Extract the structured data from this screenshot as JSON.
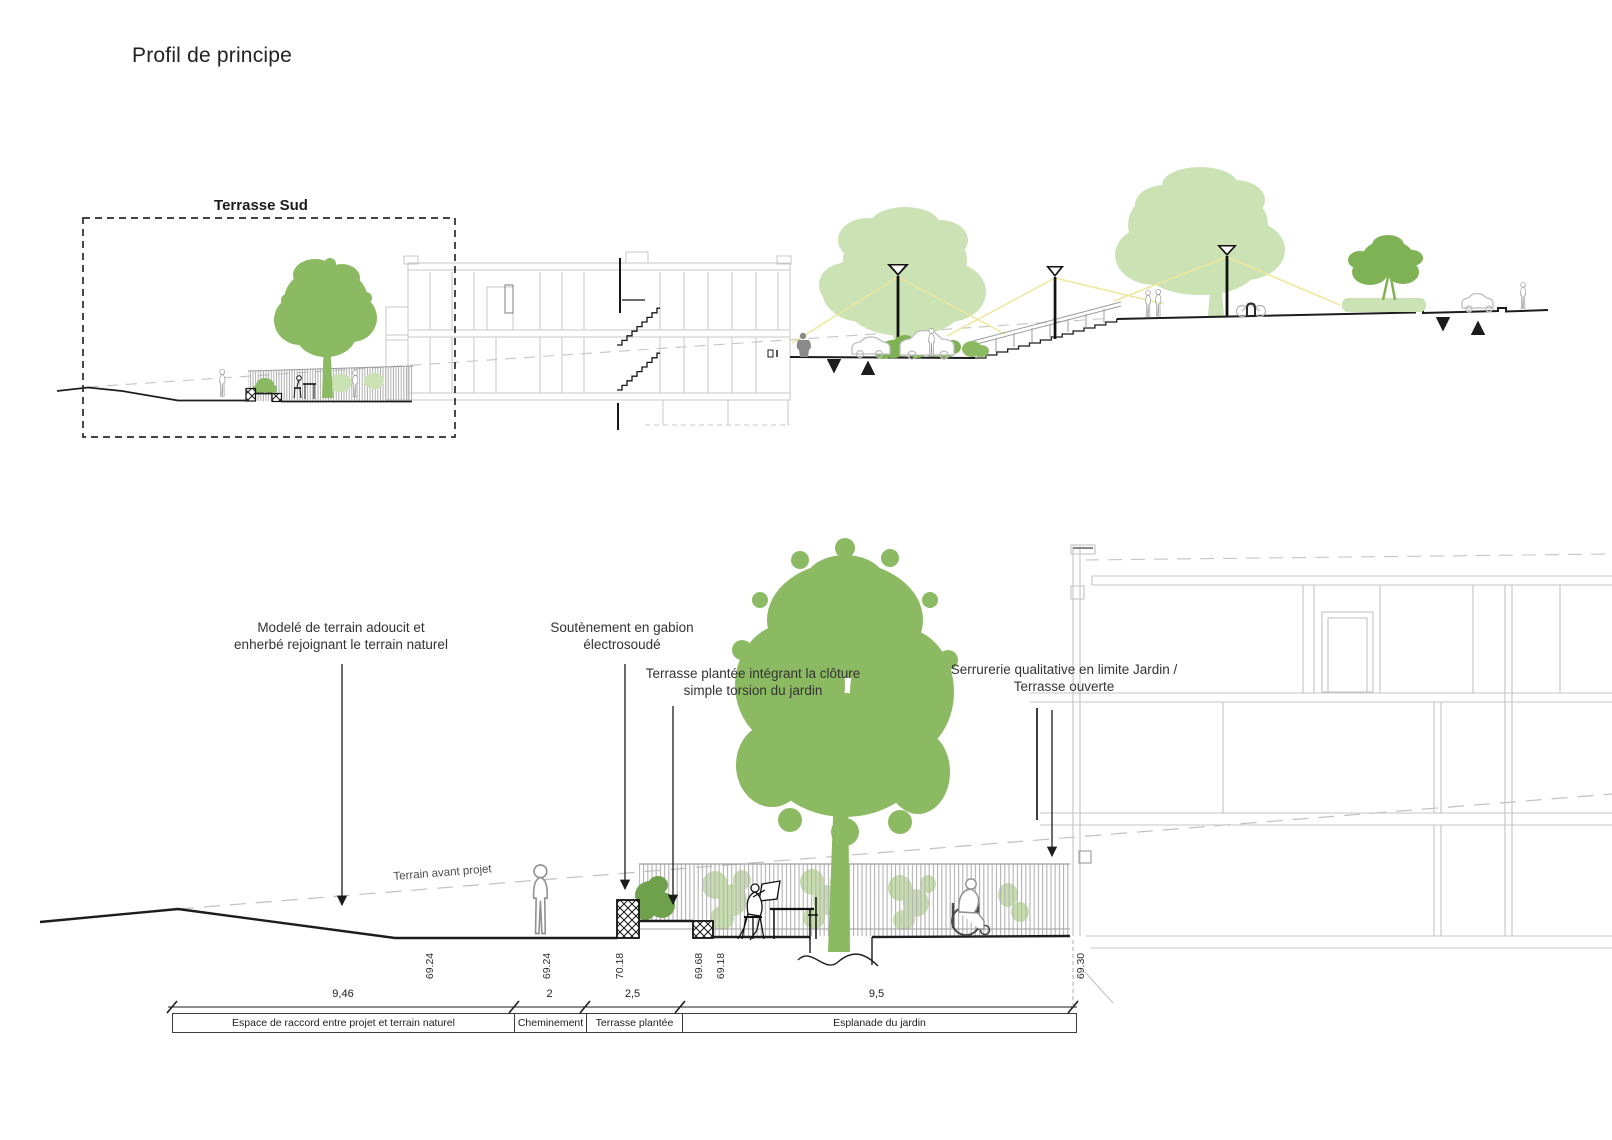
{
  "title": "Profil de principe",
  "upper_drawing": {
    "zone_label": "Terrasse Sud"
  },
  "lower_drawing": {
    "annotations": {
      "modele_line1": "Modelé de terrain adoucit et",
      "modele_line2": "enherbé rejoignant le terrain naturel",
      "soutenement_line1": "Soutènement en gabion",
      "soutenement_line2": "électrosoudé",
      "terrasse_line1": "Terrasse plantée intégrant la clôture",
      "terrasse_line2": "simple torsion du jardin",
      "serrurerie_line1": "Serrurerie qualitative en limite Jardin /",
      "serrurerie_line2": "Terrasse ouverte",
      "terrain_avant_projet": "Terrain avant projet"
    },
    "elevations": [
      "69.24",
      "69.24",
      "70.18",
      "69.68",
      "69.18",
      "69.30"
    ],
    "dimensions": [
      "9,46",
      "2",
      "2,5",
      "9,5"
    ],
    "zones": [
      "Espace de raccord entre projet et terrain naturel",
      "Cheminement",
      "Terrasse plantée",
      "Esplanade du jardin"
    ]
  },
  "colors": {
    "tree_medium": "#8cba62",
    "tree_light": "#cbe2b4",
    "shrub_dark": "#6fa04c",
    "shrub_medium": "#7fb254",
    "lamp_light_yellow": "#ece79b",
    "building_gray": "#c6c6c6",
    "fence_gray": "#b2b2b2",
    "line_black": "#1c1c1c"
  }
}
